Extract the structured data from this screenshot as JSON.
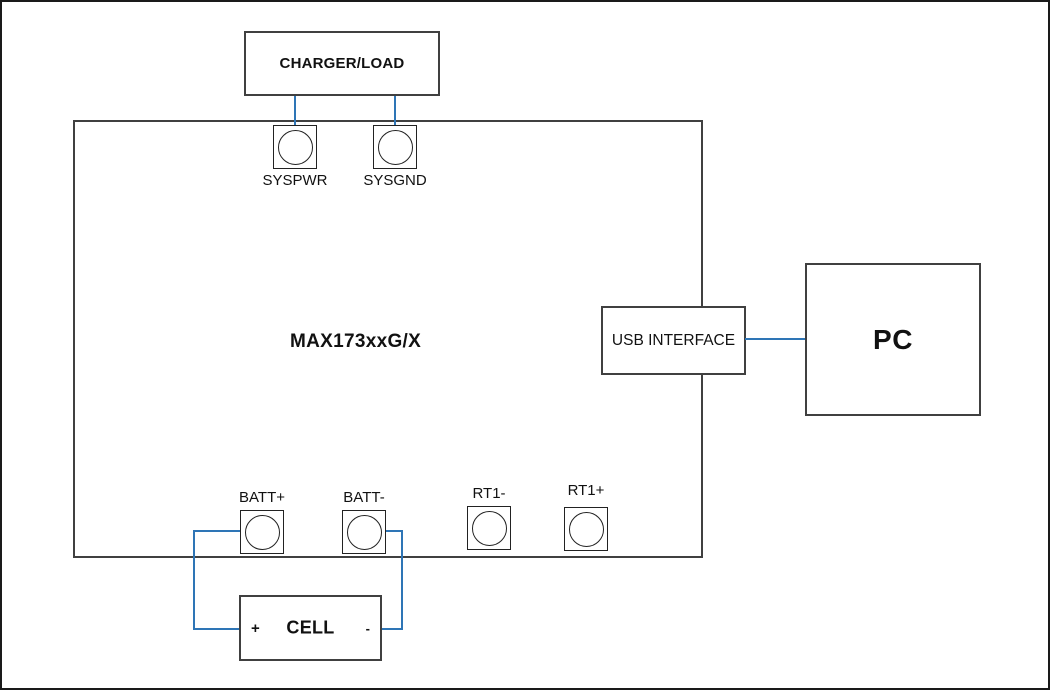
{
  "diagram": {
    "board_label": "MAX173xxG/X",
    "charger_label": "CHARGER/LOAD",
    "usb_label": "USB INTERFACE",
    "pc_label": "PC",
    "cell": {
      "label": "CELL",
      "positive_mark": "+",
      "negative_mark": "-"
    },
    "terminals": {
      "syspwr": "SYSPWR",
      "sysgnd": "SYSGND",
      "batt_plus": "BATT+",
      "batt_minus": "BATT-",
      "rt1_minus": "RT1-",
      "rt1_plus": "RT1+"
    },
    "colors": {
      "wire_blue": "#2e75b6",
      "box_border": "#404040",
      "outer_border": "#1a1a1a"
    }
  }
}
